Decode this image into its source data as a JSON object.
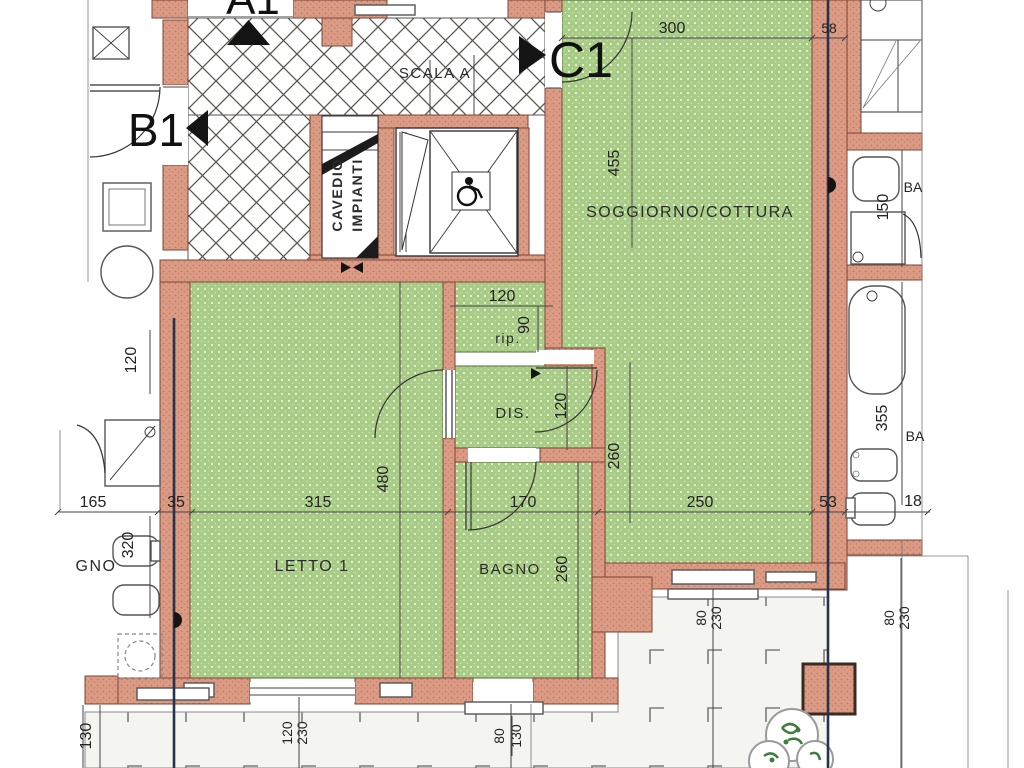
{
  "meta": {
    "document_type": "architectural floor plan (Italian apartment)",
    "clipped_labels_note": "A1 top label, GNO (BAGNO) and BA (BAGNO) are cut off by the scan edge"
  },
  "palette": {
    "wall_brick": "#db9b85",
    "wall_edge": "#7c4434",
    "room_green": "#a8cc86",
    "room_dot": "#e7f1d9",
    "stair_hatch": "#5b564f",
    "tile_floor": "#f4f4f1",
    "section_line": "#25334d",
    "marker_black": "#141414",
    "plant_green": "#3f7d3f"
  },
  "units": {
    "a1": "A1",
    "b1": "B1",
    "c1": "C1"
  },
  "rooms": {
    "scala": "SCALA A",
    "cavedio_line1": "CAVEDIO",
    "cavedio_line2": "IMPIANTI",
    "soggiorno": "SOGGIORNO/COTTURA",
    "letto": "LETTO 1",
    "bagno": "BAGNO",
    "dis": "DIS.",
    "rip": "rip.",
    "bagno_left_clipped": "GNO",
    "bagno_right_clipped_a": "BA",
    "bagno_right_clipped_b": "BA"
  },
  "dimensions": {
    "top_width": "300",
    "top_wall": "58",
    "sogg_height": "455",
    "right_upper": "150",
    "right_lower": "355",
    "right_width": "18",
    "left_height": "120",
    "left_width": "165",
    "left_wall": "35",
    "left_lower": "320",
    "letto_width": "315",
    "letto_height": "480",
    "bagno_width": "170",
    "bagno_height": "260",
    "dis_width": "120",
    "dis_height": "260",
    "rip_width": "120",
    "rip_height": "90",
    "sogg_width": "250",
    "wall_width": "53",
    "bottom_left": "130",
    "bottom_a_top": "120",
    "bottom_a_bottom": "230",
    "bottom_b_top": "80",
    "bottom_b_bottom": "130",
    "terrace_a_top": "80",
    "terrace_a_bottom": "230",
    "terrace_b_top": "80",
    "terrace_b_bottom": "230"
  }
}
